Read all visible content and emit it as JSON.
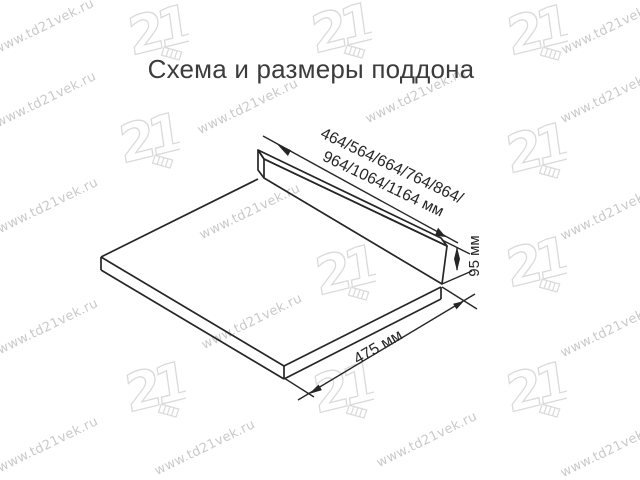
{
  "title": "Схема и размеры поддона",
  "diagram": {
    "name": "pallet-scheme",
    "width_label_line1": "464/564/664/764/864/",
    "width_label_line2": "964/1064/1164 мм",
    "height_label": "95 мм",
    "depth_label": "475 мм"
  },
  "watermark": {
    "site_text": "www.td21vek.ru",
    "logo_text": "21",
    "text_color": "#bcbcbc",
    "logo_color": "#dadada",
    "text_positions": [
      [
        44,
        27
      ],
      [
        612,
        27
      ],
      [
        46,
        100
      ],
      [
        248,
        107
      ],
      [
        416,
        96
      ],
      [
        611,
        96
      ],
      [
        48,
        206
      ],
      [
        250,
        212
      ],
      [
        611,
        213
      ],
      [
        48,
        327
      ],
      [
        252,
        322
      ],
      [
        611,
        330
      ],
      [
        48,
        445
      ],
      [
        205,
        448
      ],
      [
        427,
        440
      ],
      [
        611,
        450
      ]
    ],
    "logo_positions": [
      [
        155,
        32
      ],
      [
        338,
        30
      ],
      [
        534,
        32
      ],
      [
        146,
        140
      ],
      [
        533,
        150
      ],
      [
        342,
        272
      ],
      [
        533,
        264
      ],
      [
        152,
        389
      ],
      [
        340,
        390
      ],
      [
        533,
        389
      ]
    ]
  },
  "colors": {
    "line": "#262626",
    "title": "#3c3c3c",
    "background": "#ffffff"
  }
}
